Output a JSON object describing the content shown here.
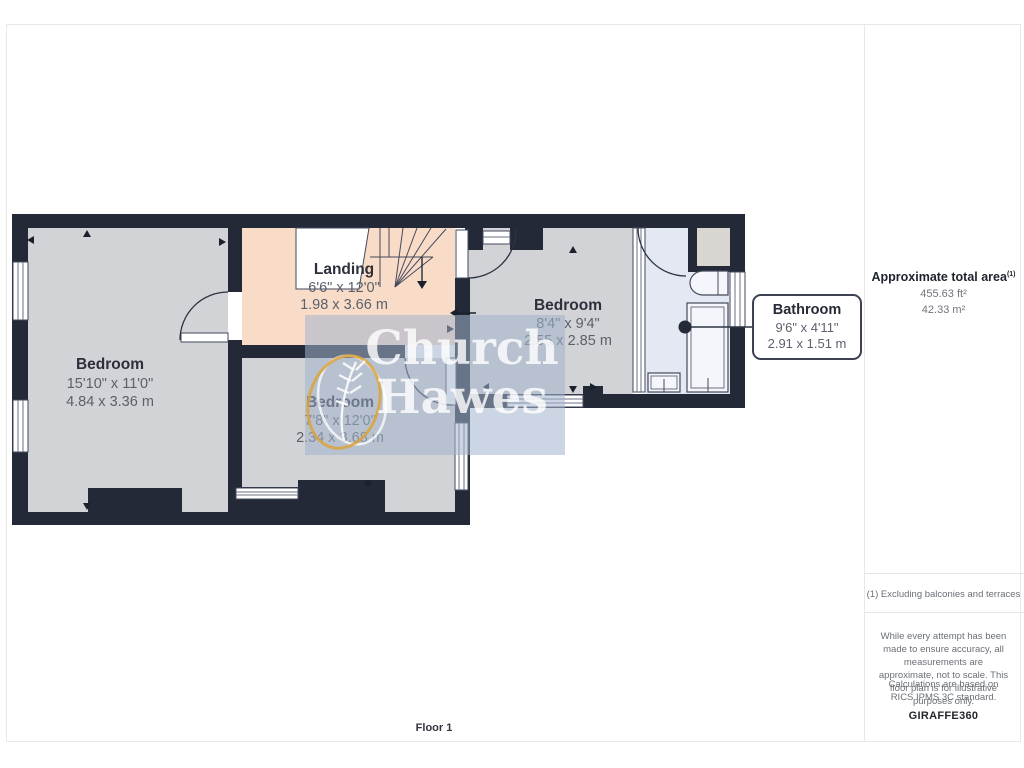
{
  "colors": {
    "wall": "#232936",
    "room_fill": "#d2d3d6",
    "landing_fill": "#f8dcc8",
    "bathroom_fill": "#e4e8f2",
    "watermark_gold": "#d9a33c"
  },
  "rooms": {
    "bedroom_left": {
      "name": "Bedroom",
      "imperial": "15'10\" x 11'0\"",
      "metric": "4.84 x 3.36 m"
    },
    "landing": {
      "name": "Landing",
      "imperial": "6'6\" x 12'0\"",
      "metric": "1.98 x 3.66 m"
    },
    "bedroom_middle": {
      "name": "Bedroom",
      "imperial": "7'8\" x 12'0\"",
      "metric": "2.34 x 3.68 m"
    },
    "bedroom_right": {
      "name": "Bedroom",
      "imperial": "8'4\" x 9'4\"",
      "metric": "2.55 x 2.85 m"
    },
    "bathroom": {
      "name": "Bathroom",
      "imperial": "9'6\" x 4'11\"",
      "metric": "2.91 x 1.51 m"
    }
  },
  "watermark": {
    "word1": "Church",
    "word2": "Hawes"
  },
  "sidebar": {
    "total_area_title": "Approximate total area",
    "total_area_note_ref": "(1)",
    "area_imperial": "455.63 ft²",
    "area_metric": "42.33 m²",
    "footnote": "(1) Excluding balconies and terraces",
    "disclaimer": "While every attempt has been made to ensure accuracy, all measurements are approximate, not to scale. This floor plan is for illustrative purposes only.",
    "standard_note": "Calculations are based on RICS IPMS 3C standard.",
    "brand": "GIRAFFE",
    "brand_number": "360"
  },
  "footer": {
    "floor_label": "Floor 1"
  }
}
